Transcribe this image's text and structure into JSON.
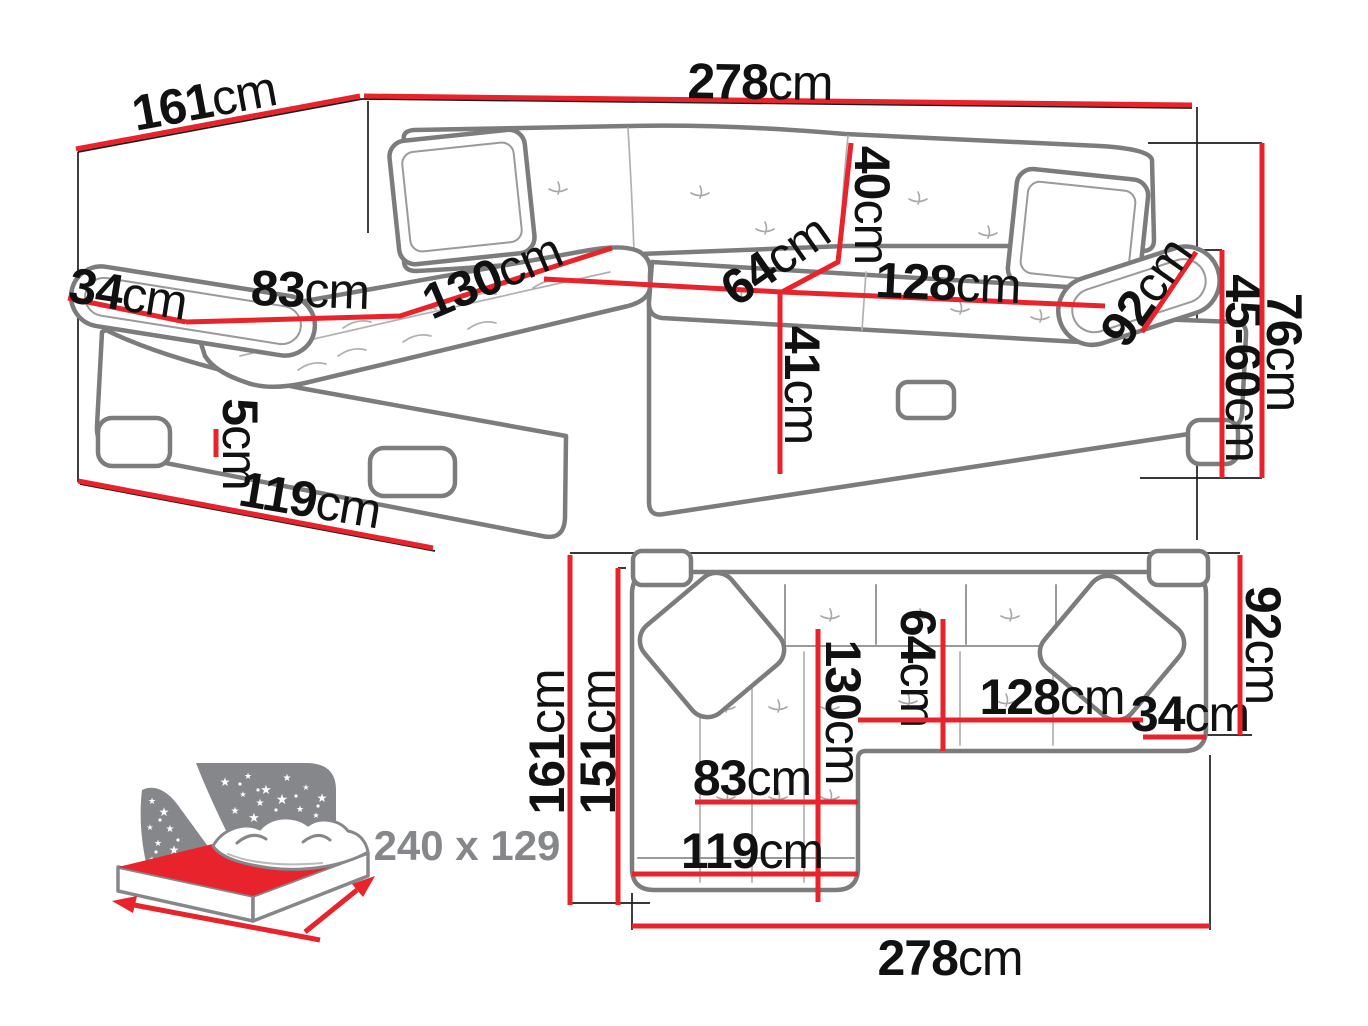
{
  "colors": {
    "dimension_red": "#e8232b",
    "sofa_outline_gray": "#7c7c7c",
    "label_black": "#111111",
    "icon_gray": "#85878a",
    "background": "#ffffff"
  },
  "perspective_view": {
    "dims": {
      "d278": {
        "value": "278",
        "unit": "cm"
      },
      "d161": {
        "value": "161",
        "unit": "cm"
      },
      "d34": {
        "value": "34",
        "unit": "cm"
      },
      "d83": {
        "value": "83",
        "unit": "cm"
      },
      "d130": {
        "value": "130",
        "unit": "cm"
      },
      "d40": {
        "value": "40",
        "unit": "cm"
      },
      "d64": {
        "value": "64",
        "unit": "cm"
      },
      "d128": {
        "value": "128",
        "unit": "cm"
      },
      "d92": {
        "value": "92",
        "unit": "cm"
      },
      "d4560": {
        "value": "45-60",
        "unit": "cm"
      },
      "d76": {
        "value": "76",
        "unit": "cm"
      },
      "d41": {
        "value": "41",
        "unit": "cm"
      },
      "d5": {
        "value": "5",
        "unit": "cm"
      },
      "d119": {
        "value": "119",
        "unit": "cm"
      }
    }
  },
  "plan_view": {
    "dims": {
      "d161": {
        "value": "161",
        "unit": "cm"
      },
      "d151": {
        "value": "151",
        "unit": "cm"
      },
      "d130": {
        "value": "130",
        "unit": "cm"
      },
      "d64": {
        "value": "64",
        "unit": "cm"
      },
      "d128": {
        "value": "128",
        "unit": "cm"
      },
      "d34": {
        "value": "34",
        "unit": "cm"
      },
      "d92": {
        "value": "92",
        "unit": "cm"
      },
      "d83": {
        "value": "83",
        "unit": "cm"
      },
      "d119": {
        "value": "119",
        "unit": "cm"
      },
      "d278": {
        "value": "278",
        "unit": "cm"
      }
    }
  },
  "sleeping_icon": {
    "label": "240 x 129"
  }
}
